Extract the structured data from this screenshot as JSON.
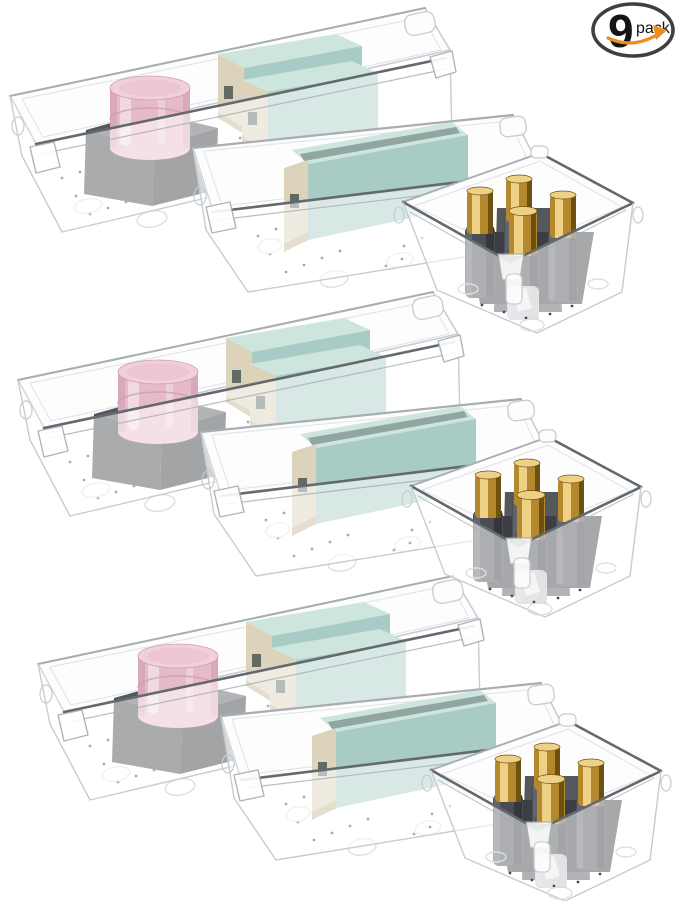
{
  "image": {
    "alt": "9 pack clear plastic drawer organizer trays shown three times: a long tray holding a pink cream jar on a black box and two mint green boxes with beige ends, a medium tray holding one mint green box, and a small square bin holding four dark bottles with gold caps",
    "background": "#ffffff"
  },
  "badge": {
    "count": "9",
    "unit": "pack",
    "icon": "smile-arrow-icon"
  },
  "product": {
    "sets_count": 3,
    "set_contents": [
      {
        "tray": "long-drawer-tray",
        "items": [
          {
            "name": "pink-cream-jar",
            "count": 1
          },
          {
            "name": "black-cosmetic-box",
            "count": 1
          },
          {
            "name": "mint-green-box",
            "count": 2
          }
        ]
      },
      {
        "tray": "medium-drawer-tray",
        "items": [
          {
            "name": "mint-green-box",
            "count": 1
          }
        ]
      },
      {
        "tray": "small-square-bin",
        "items": [
          {
            "name": "gold-cap-bottle",
            "count": 4
          }
        ]
      }
    ]
  },
  "colors": {
    "background": "#ffffff",
    "plastic_face": "#fdfdfe",
    "plastic_outline": "#c6ccd1",
    "plastic_outline_light": "#e2e6e9",
    "rim_dark": "#63696f",
    "rim_mid": "#a7adb2",
    "dot": "#43494e",
    "foot_ring": "#dce0e4",
    "mint_top": "#cde5dd",
    "mint_front": "#a8ccc5",
    "mint_slot": "#36484a",
    "beige": "#ddd2ba",
    "beige_shade": "#c6b795",
    "cube_top": "#54585d",
    "cube_front": "#34373b",
    "cube_side": "#42464a",
    "jar_light": "#f1d0da",
    "jar_mid": "#e6bac7",
    "jar_dark": "#cf9fb0",
    "bottle_body": "#4a4e53",
    "bottle_body_dark": "#2f3338",
    "bottle_body_light": "#63686e",
    "bottle_glass": "#edeff1",
    "gold_light": "#eed187",
    "gold_mid": "#b4882c",
    "gold_dark": "#6e5110",
    "holder": "#3b3e42",
    "holder_top": "#54585d",
    "badge_border": "#3f3f3f",
    "badge_text": "#141414",
    "badge_orange": "#ee8d1e"
  }
}
